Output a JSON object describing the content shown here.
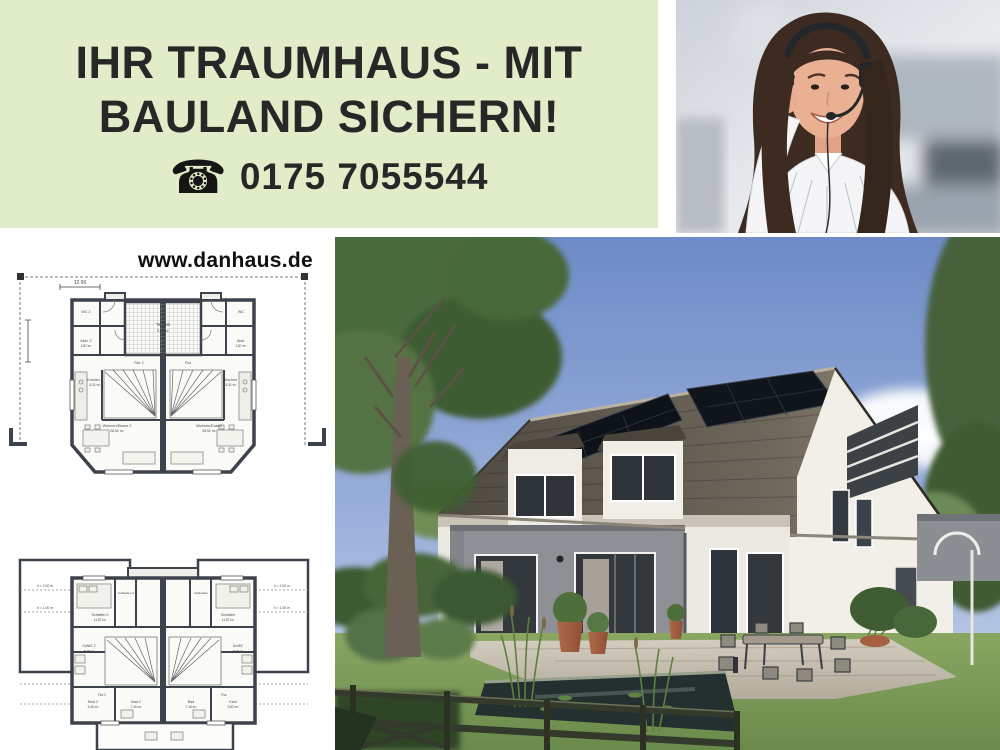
{
  "ad": {
    "headline_line1": "IHR TRAUMHAUS - MIT",
    "headline_line2": "BAULAND SICHERN!",
    "phone_icon": "☎",
    "phone_number": "0175 7055544",
    "website": "www.danhaus.de",
    "colors": {
      "panel_green": "#e0edc8",
      "headline_text": "#272727",
      "plan_wall": "#3c434c",
      "sky_blue": "#6e8bc7",
      "roof_dark": "#4f4a42",
      "lawn_green": "#7d9a57",
      "pot_terracotta": "#a55f41"
    }
  },
  "floorplan_ground": {
    "overall_width_dim": "12.96",
    "rooms": {
      "technik": {
        "label": "Technik",
        "area": "9.69 m²"
      },
      "wc2": {
        "label": "WC 2"
      },
      "abst2": {
        "label": "Abst. 2",
        "area": "2.87 m²"
      },
      "flur2": {
        "label": "Flur 2"
      },
      "kochen2": {
        "label": "Kochen 2",
        "area": "8.31 m²"
      },
      "wohnen2": {
        "label": "Wohnen/Essen 2",
        "area": "28.52 m²"
      },
      "wc": {
        "label": "WC"
      },
      "abst": {
        "label": "Abst.",
        "area": "2.87 m²"
      },
      "flur": {
        "label": "Flur"
      },
      "kochen": {
        "label": "Kochen",
        "area": "8.31 m²"
      },
      "wohnen": {
        "label": "Wohnen/Essen",
        "area": "28.52 m²"
      }
    }
  },
  "floorplan_upper": {
    "height_note_upper": "h = 2.00 m",
    "height_note_lower": "h = 1.00 m",
    "rooms": {
      "schlafen2": {
        "label": "Schlafen 2",
        "area": "11.87 m²"
      },
      "ankleiden2": {
        "label": "Ankleiden 2"
      },
      "ankleiden": {
        "label": "Ankleiden"
      },
      "schlafen": {
        "label": "Schlafen",
        "area": "11.87 m²"
      },
      "duwc2": {
        "label": "Du/WC 2",
        "area": "5.38 m²"
      },
      "duwc": {
        "label": "Du/WC",
        "area": "5.38 m²"
      },
      "flur2": {
        "label": "Flur 2"
      },
      "flur": {
        "label": "Flur"
      },
      "kind2": {
        "label": "Kind 2",
        "area": "9.49 m²"
      },
      "bad2": {
        "label": "Bad 2",
        "area": "7.16 m²"
      },
      "bad": {
        "label": "Bad",
        "area": "7.16 m²"
      },
      "kind": {
        "label": "Kind",
        "area": "9.62 m²"
      }
    }
  }
}
